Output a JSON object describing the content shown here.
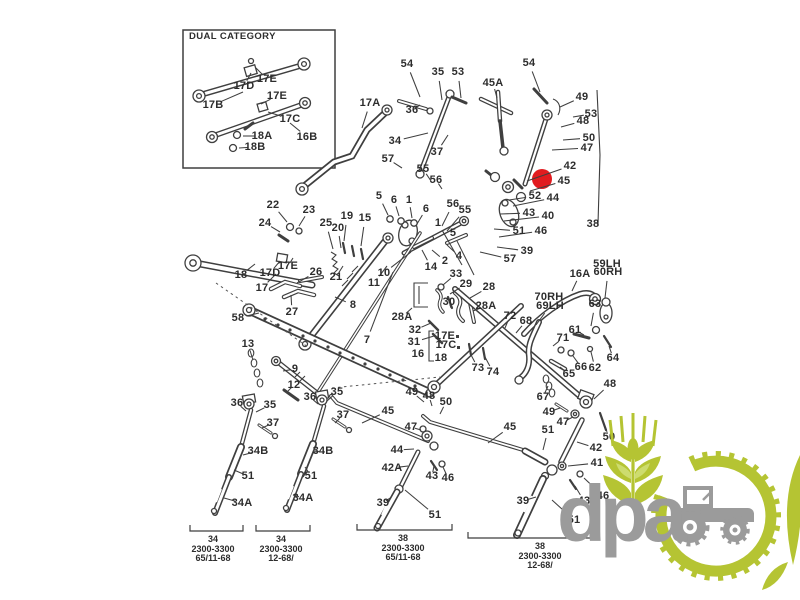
{
  "inset": {
    "title": "DUAL CATEGORY"
  },
  "colors": {
    "background": "#ffffff",
    "line": "#3f3f3f",
    "label": "#2d2d2d",
    "highlight": "#e11b1f",
    "logo_green": "#b5c433",
    "logo_light_green": "#cddc6e",
    "logo_gray": "#9b9b9b"
  },
  "highlight": {
    "x": 542,
    "y": 179,
    "r": 10
  },
  "watermark": {
    "text": "dpa"
  },
  "labels": [
    {
      "t": "17D",
      "x": 244,
      "y": 86,
      "e": [
        251,
        73
      ]
    },
    {
      "t": "17E",
      "x": 267,
      "y": 79,
      "e": [
        256,
        68
      ]
    },
    {
      "t": "17B",
      "x": 213,
      "y": 105,
      "e": [
        243,
        92
      ]
    },
    {
      "t": "17E",
      "x": 277,
      "y": 96,
      "e": [
        261,
        104
      ]
    },
    {
      "t": "17C",
      "x": 290,
      "y": 119,
      "e": [
        268,
        112
      ]
    },
    {
      "t": "18A",
      "x": 262,
      "y": 136,
      "e": [
        243,
        136
      ]
    },
    {
      "t": "16B",
      "x": 307,
      "y": 137,
      "e": [
        290,
        123
      ]
    },
    {
      "t": "18B",
      "x": 255,
      "y": 147,
      "e": [
        239,
        148
      ]
    },
    {
      "t": "54",
      "x": 407,
      "y": 64,
      "e": [
        420,
        97
      ]
    },
    {
      "t": "35",
      "x": 438,
      "y": 72,
      "e": [
        442,
        100
      ]
    },
    {
      "t": "53",
      "x": 458,
      "y": 72,
      "e": [
        461,
        98
      ]
    },
    {
      "t": "45A",
      "x": 493,
      "y": 83,
      "e": [
        497,
        98
      ]
    },
    {
      "t": "54",
      "x": 529,
      "y": 63,
      "e": [
        540,
        92
      ]
    },
    {
      "t": "49",
      "x": 582,
      "y": 97,
      "e": [
        560,
        107
      ]
    },
    {
      "t": "53",
      "x": 591,
      "y": 114,
      "e": [
        573,
        117
      ]
    },
    {
      "t": "48",
      "x": 583,
      "y": 121,
      "e": [
        561,
        127
      ]
    },
    {
      "t": "50",
      "x": 589,
      "y": 138,
      "e": [
        563,
        140
      ]
    },
    {
      "t": "47",
      "x": 587,
      "y": 148,
      "e": [
        552,
        150
      ]
    },
    {
      "t": "17A",
      "x": 370,
      "y": 103,
      "e": [
        362,
        128
      ]
    },
    {
      "t": "36",
      "x": 412,
      "y": 110,
      "e": [
        420,
        105
      ]
    },
    {
      "t": "34",
      "x": 395,
      "y": 141,
      "e": [
        428,
        133
      ]
    },
    {
      "t": "37",
      "x": 437,
      "y": 152,
      "e": [
        448,
        135
      ]
    },
    {
      "t": "57",
      "x": 388,
      "y": 159,
      "e": [
        402,
        168
      ]
    },
    {
      "t": "55",
      "x": 423,
      "y": 169,
      "e": [
        431,
        181
      ]
    },
    {
      "t": "56",
      "x": 436,
      "y": 180,
      "e": [
        442,
        189
      ]
    },
    {
      "t": "42",
      "x": 570,
      "y": 166,
      "e": [
        527,
        181
      ]
    },
    {
      "t": "45",
      "x": 564,
      "y": 181,
      "e": [
        530,
        191
      ]
    },
    {
      "t": "52",
      "x": 535,
      "y": 196,
      "e": [
        509,
        200
      ]
    },
    {
      "t": "44",
      "x": 553,
      "y": 198,
      "e": [
        513,
        206
      ]
    },
    {
      "t": "43",
      "x": 529,
      "y": 213,
      "e": [
        500,
        214
      ]
    },
    {
      "t": "40",
      "x": 548,
      "y": 216,
      "e": [
        504,
        221
      ]
    },
    {
      "t": "38",
      "x": 593,
      "y": 224
    },
    {
      "t": "51",
      "x": 519,
      "y": 231,
      "e": [
        494,
        229
      ]
    },
    {
      "t": "46",
      "x": 541,
      "y": 231,
      "e": [
        499,
        237
      ]
    },
    {
      "t": "39",
      "x": 527,
      "y": 251,
      "e": [
        497,
        247
      ]
    },
    {
      "t": "57",
      "x": 510,
      "y": 259,
      "e": [
        480,
        252
      ]
    },
    {
      "t": "5",
      "x": 379,
      "y": 196,
      "e": [
        388,
        215
      ]
    },
    {
      "t": "6",
      "x": 394,
      "y": 200,
      "e": [
        399,
        216
      ]
    },
    {
      "t": "1",
      "x": 409,
      "y": 200,
      "e": [
        412,
        218
      ]
    },
    {
      "t": "6",
      "x": 426,
      "y": 209,
      "e": [
        417,
        224
      ]
    },
    {
      "t": "56",
      "x": 453,
      "y": 204,
      "e": [
        442,
        226
      ]
    },
    {
      "t": "55",
      "x": 465,
      "y": 210,
      "e": [
        447,
        231
      ]
    },
    {
      "t": "1",
      "x": 438,
      "y": 223,
      "e": [
        462,
        265
      ]
    },
    {
      "t": "5",
      "x": 453,
      "y": 233,
      "e": [
        474,
        275
      ]
    },
    {
      "t": "2",
      "x": 445,
      "y": 261,
      "e": [
        432,
        250
      ]
    },
    {
      "t": "4",
      "x": 459,
      "y": 256,
      "e": [
        447,
        245
      ]
    },
    {
      "t": "14",
      "x": 431,
      "y": 267,
      "e": [
        422,
        250
      ]
    },
    {
      "t": "22",
      "x": 273,
      "y": 205,
      "e": [
        287,
        222
      ]
    },
    {
      "t": "23",
      "x": 309,
      "y": 210,
      "e": [
        299,
        226
      ]
    },
    {
      "t": "24",
      "x": 265,
      "y": 223,
      "e": [
        280,
        232
      ]
    },
    {
      "t": "25",
      "x": 326,
      "y": 223,
      "e": [
        333,
        249
      ]
    },
    {
      "t": "19",
      "x": 347,
      "y": 216,
      "e": [
        344,
        241
      ]
    },
    {
      "t": "15",
      "x": 365,
      "y": 218,
      "e": [
        361,
        246
      ]
    },
    {
      "t": "20",
      "x": 338,
      "y": 228,
      "e": [
        341,
        248
      ]
    },
    {
      "t": "26",
      "x": 316,
      "y": 272,
      "e": [
        297,
        283
      ]
    },
    {
      "t": "21",
      "x": 336,
      "y": 277,
      "e": [
        343,
        266
      ]
    },
    {
      "t": "10",
      "x": 384,
      "y": 273,
      "e": [
        411,
        252
      ]
    },
    {
      "t": "11",
      "x": 374,
      "y": 283,
      "e": [
        387,
        266
      ]
    },
    {
      "t": "18",
      "x": 241,
      "y": 275,
      "e": [
        255,
        264
      ]
    },
    {
      "t": "17D",
      "x": 270,
      "y": 273,
      "e": [
        280,
        261
      ]
    },
    {
      "t": "17E",
      "x": 288,
      "y": 266,
      "e": [
        293,
        258
      ]
    },
    {
      "t": "17",
      "x": 262,
      "y": 288,
      "e": [
        276,
        274
      ]
    },
    {
      "t": "27",
      "x": 292,
      "y": 312,
      "e": [
        291,
        295
      ]
    },
    {
      "t": "58",
      "x": 238,
      "y": 318,
      "e": [
        259,
        313
      ]
    },
    {
      "t": "8",
      "x": 353,
      "y": 305,
      "e": [
        335,
        297
      ]
    },
    {
      "t": "7",
      "x": 367,
      "y": 340,
      "e": [
        393,
        272
      ]
    },
    {
      "t": "13",
      "x": 248,
      "y": 344,
      "e": [
        253,
        360
      ]
    },
    {
      "t": "9",
      "x": 295,
      "y": 369,
      "e": [
        283,
        371
      ]
    },
    {
      "t": "12",
      "x": 294,
      "y": 385,
      "e": [
        288,
        391
      ]
    },
    {
      "t": "33",
      "x": 456,
      "y": 274,
      "e": [
        443,
        285
      ]
    },
    {
      "t": "29",
      "x": 466,
      "y": 284,
      "e": [
        450,
        294
      ]
    },
    {
      "t": "28",
      "x": 489,
      "y": 287,
      "e": [
        470,
        298
      ]
    },
    {
      "t": "30",
      "x": 449,
      "y": 302,
      "e": [
        451,
        308
      ]
    },
    {
      "t": "28A",
      "x": 402,
      "y": 317,
      "e": [
        412,
        308
      ]
    },
    {
      "t": "32",
      "x": 415,
      "y": 330,
      "e": [
        431,
        323
      ]
    },
    {
      "t": "31",
      "x": 414,
      "y": 342,
      "e": [
        434,
        336
      ]
    },
    {
      "t": "17E",
      "x": 445,
      "y": 336
    },
    {
      "t": "17C",
      "x": 446,
      "y": 345
    },
    {
      "t": "16",
      "x": 418,
      "y": 354
    },
    {
      "t": "18",
      "x": 441,
      "y": 358
    },
    {
      "t": "28A",
      "x": 486,
      "y": 306,
      "e": [
        473,
        311
      ]
    },
    {
      "t": "72",
      "x": 510,
      "y": 316,
      "e": [
        505,
        328
      ]
    },
    {
      "t": "68",
      "x": 526,
      "y": 321,
      "e": [
        516,
        333
      ]
    },
    {
      "t": "70RH",
      "x": 549,
      "y": 297
    },
    {
      "t": "69LH",
      "x": 550,
      "y": 306,
      "e": [
        536,
        325
      ]
    },
    {
      "t": "16A",
      "x": 580,
      "y": 274,
      "e": [
        572,
        291
      ]
    },
    {
      "t": "59LH",
      "x": 607,
      "y": 264
    },
    {
      "t": "60RH",
      "x": 608,
      "y": 272,
      "e": [
        605,
        298
      ]
    },
    {
      "t": "63",
      "x": 595,
      "y": 304,
      "e": [
        591,
        326
      ]
    },
    {
      "t": "61",
      "x": 575,
      "y": 330,
      "e": [
        584,
        335
      ]
    },
    {
      "t": "71",
      "x": 563,
      "y": 338,
      "e": [
        553,
        346
      ]
    },
    {
      "t": "64",
      "x": 613,
      "y": 358,
      "e": [
        609,
        346
      ]
    },
    {
      "t": "66",
      "x": 581,
      "y": 367,
      "e": [
        573,
        356
      ]
    },
    {
      "t": "62",
      "x": 595,
      "y": 368,
      "e": [
        591,
        352
      ]
    },
    {
      "t": "65",
      "x": 569,
      "y": 374,
      "e": [
        560,
        367
      ]
    },
    {
      "t": "73",
      "x": 478,
      "y": 368,
      "e": [
        470,
        353
      ]
    },
    {
      "t": "74",
      "x": 493,
      "y": 372,
      "e": [
        485,
        357
      ]
    },
    {
      "t": "67",
      "x": 543,
      "y": 397,
      "e": [
        548,
        386
      ]
    },
    {
      "t": "49",
      "x": 412,
      "y": 392,
      "e": [
        424,
        402
      ]
    },
    {
      "t": "48",
      "x": 429,
      "y": 396,
      "e": [
        432,
        406
      ]
    },
    {
      "t": "50",
      "x": 446,
      "y": 402,
      "e": [
        440,
        414
      ]
    },
    {
      "t": "45",
      "x": 388,
      "y": 411,
      "e": [
        362,
        423
      ]
    },
    {
      "t": "47",
      "x": 411,
      "y": 427,
      "e": [
        421,
        430
      ]
    },
    {
      "t": "44",
      "x": 397,
      "y": 450,
      "e": [
        414,
        449
      ]
    },
    {
      "t": "42A",
      "x": 392,
      "y": 468,
      "e": [
        408,
        466
      ]
    },
    {
      "t": "43",
      "x": 432,
      "y": 476,
      "e": [
        434,
        466
      ]
    },
    {
      "t": "46",
      "x": 448,
      "y": 478,
      "e": [
        443,
        467
      ]
    },
    {
      "t": "39",
      "x": 383,
      "y": 503,
      "e": [
        390,
        498
      ]
    },
    {
      "t": "51",
      "x": 435,
      "y": 515,
      "e": [
        405,
        490
      ]
    },
    {
      "t": "36",
      "x": 237,
      "y": 403,
      "e": [
        246,
        411
      ]
    },
    {
      "t": "35",
      "x": 270,
      "y": 405,
      "e": [
        256,
        412
      ]
    },
    {
      "t": "37",
      "x": 273,
      "y": 423,
      "e": [
        262,
        428
      ]
    },
    {
      "t": "34B",
      "x": 258,
      "y": 451,
      "e": [
        243,
        455
      ]
    },
    {
      "t": "51",
      "x": 248,
      "y": 476,
      "e": [
        234,
        470
      ]
    },
    {
      "t": "34A",
      "x": 242,
      "y": 503,
      "e": [
        224,
        498
      ]
    },
    {
      "t": "36",
      "x": 310,
      "y": 397,
      "e": [
        318,
        404
      ]
    },
    {
      "t": "35",
      "x": 337,
      "y": 392,
      "e": [
        327,
        401
      ]
    },
    {
      "t": "37",
      "x": 343,
      "y": 415,
      "e": [
        335,
        423
      ]
    },
    {
      "t": "34B",
      "x": 323,
      "y": 451,
      "e": [
        313,
        452
      ]
    },
    {
      "t": "51",
      "x": 311,
      "y": 476,
      "e": [
        305,
        467
      ]
    },
    {
      "t": "34A",
      "x": 303,
      "y": 498,
      "e": [
        293,
        495
      ]
    },
    {
      "t": "45",
      "x": 510,
      "y": 427,
      "e": [
        488,
        443
      ]
    },
    {
      "t": "51",
      "x": 548,
      "y": 430,
      "e": [
        543,
        450
      ]
    },
    {
      "t": "39",
      "x": 523,
      "y": 501,
      "e": [
        536,
        497
      ]
    },
    {
      "t": "49",
      "x": 549,
      "y": 412,
      "e": [
        560,
        408
      ]
    },
    {
      "t": "47",
      "x": 563,
      "y": 422,
      "e": [
        573,
        417
      ]
    },
    {
      "t": "48",
      "x": 610,
      "y": 384,
      "e": [
        594,
        399
      ]
    },
    {
      "t": "50",
      "x": 609,
      "y": 437,
      "e": [
        604,
        424
      ]
    },
    {
      "t": "42",
      "x": 596,
      "y": 448,
      "e": [
        577,
        442
      ]
    },
    {
      "t": "41",
      "x": 597,
      "y": 463,
      "e": [
        568,
        466
      ]
    },
    {
      "t": "46",
      "x": 603,
      "y": 496,
      "e": [
        584,
        478
      ]
    },
    {
      "t": "43",
      "x": 584,
      "y": 501,
      "e": [
        575,
        486
      ]
    },
    {
      "t": "51",
      "x": 574,
      "y": 520,
      "e": [
        552,
        500
      ]
    }
  ],
  "assemblies": [
    {
      "part": "34",
      "model": "2300-3300",
      "serial": "65/11-68",
      "cx": 213,
      "x1": 190,
      "x2": 243,
      "by": 531
    },
    {
      "part": "34",
      "model": "2300-3300",
      "serial": "12-68/",
      "cx": 281,
      "x1": 256,
      "x2": 310,
      "by": 531
    },
    {
      "part": "38",
      "model": "2300-3300",
      "serial": "65/11-68",
      "cx": 403,
      "x1": 357,
      "x2": 452,
      "by": 530
    },
    {
      "part": "38",
      "model": "2300-3300",
      "serial": "12-68/",
      "cx": 540,
      "x1": 468,
      "x2": 596,
      "by": 538
    }
  ]
}
